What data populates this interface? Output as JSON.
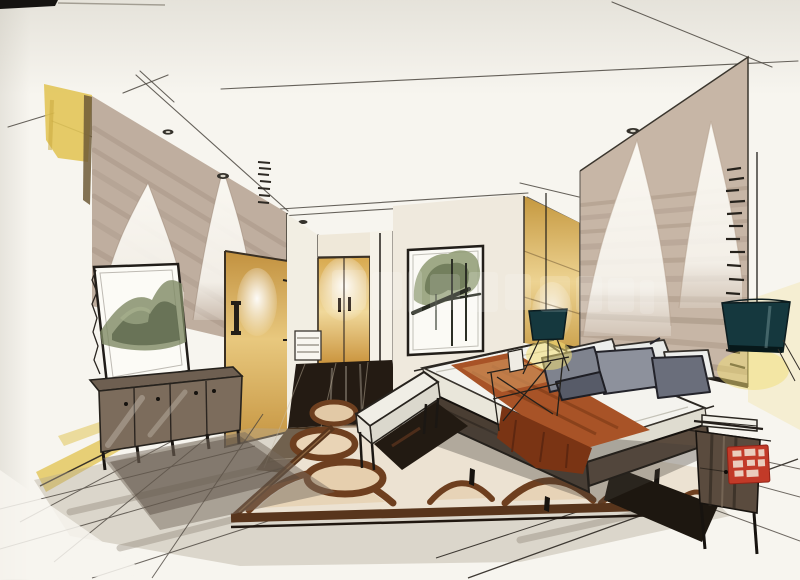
{
  "artwork": {
    "kind": "hand-drawn interior design marker rendering",
    "scene": "modern bedroom perspective sketch",
    "medium": "ink liner and marker on paper"
  },
  "palette": {
    "paper": "#f7f5ef",
    "paperDim": "#eceae2",
    "yellowAccent": "#e2c558",
    "taupeWall": "#bfae9f",
    "tanPanel": "#c7b6a6",
    "creamWall": "#efe9dd",
    "innerWall": "#f2eee3",
    "woodDark": "#4a3e33",
    "woodMid": "#5a4b3e",
    "cabinetWood": "#7c6c5c",
    "mattress": "#f4f3ee",
    "rust": "#a85327",
    "rustDeep": "#7a3414",
    "rustLight": "#c98954",
    "pillowGray": "#7f838e",
    "pillowGrayLight": "#8d919c",
    "pillowGrayDark": "#6a6e7b",
    "pillowWhite": "#edeeec",
    "tealLamp": "#15383e",
    "rugField": "#ece2d2",
    "rugBrown": "#6e3f1f",
    "rugBorder": "#58351c",
    "alcoveFloor": "#241b13",
    "brownFloor": "#47331f",
    "voidDark": "#221a12",
    "darkWedge": "#1d1710",
    "foliage": "#8e9a72",
    "foliageDark": "#616d4c",
    "sealRed": "#c23a28",
    "glowYellow": "#f2de76"
  },
  "elements": {
    "ceiling_downlights": "recessed ceiling downlights",
    "left_accent_panel": "yellow marker accent panel",
    "left_arch_wall": "taupe wall panel with white arch motifs (left)",
    "right_arch_wall": "taupe feature wall with white arch motifs (right)",
    "entry_door": "golden wood door with long pull handle",
    "wardrobe": "backlit golden wardrobe double doors",
    "towel_rack": "small white slatted rack",
    "landscape_painting": "ink-wash mountain painting leaning on wall",
    "scroll_painting": "framed ink tree painting on wall",
    "media_cabinet": "long dark wood media cabinet",
    "bed": "platform bed with white mattress",
    "throw_runner": "rust-brown bed runner",
    "pillows": "gray and white pillows",
    "foot_bench": "white upholstered foot bench",
    "nightstand": "dark wood nightstand with books",
    "side_table": "sketched folding side table",
    "pendant_lamp": "dark teal pendant lamp",
    "table_lamp": "dark teal table lamp",
    "rug": "cream rug with brown arch and ring pattern",
    "artist_seal": "red artist seal stamp (characters illegible)",
    "watermark": "faint semi-transparent watermark (illegible)"
  }
}
